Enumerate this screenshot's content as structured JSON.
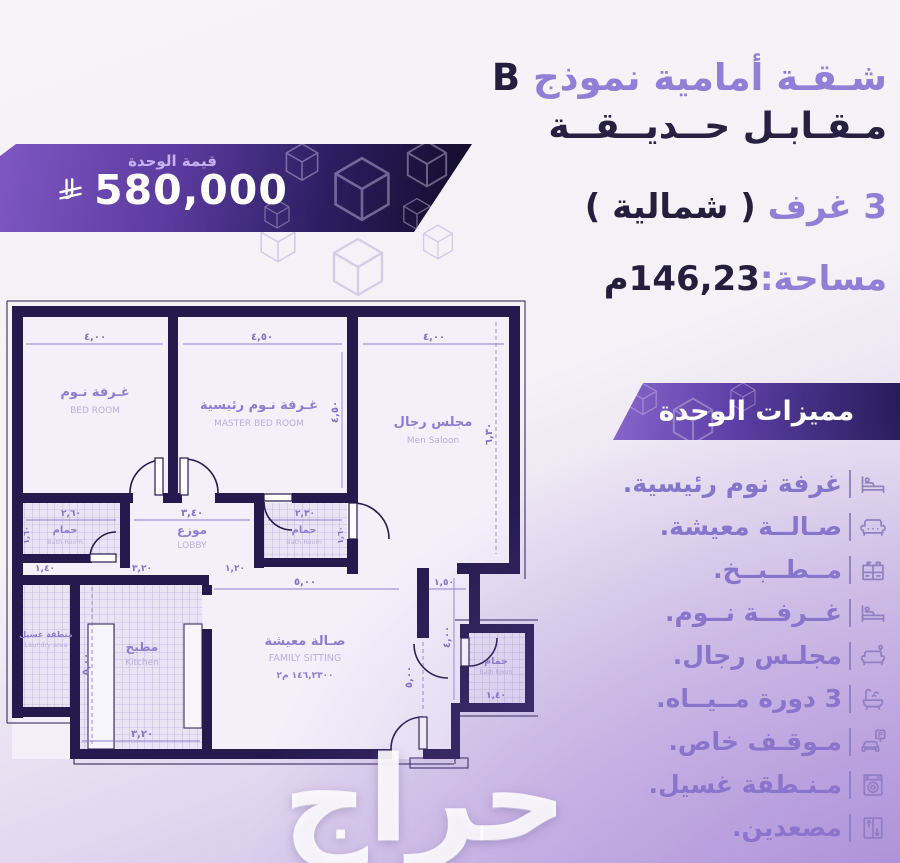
{
  "page": {
    "watermark": "حراج"
  },
  "price_banner": {
    "label": "قيمة الوحدة",
    "amount": "580,000",
    "currency_icon": "saudi-riyal-icon"
  },
  "header": {
    "title": "شـقـة أمامية نموذج",
    "title_model": "B",
    "subtitle": "مـقـابـل حــديــقــة",
    "rooms_count": "3 غرف",
    "rooms_side": "( شمالية )",
    "area_label": "مساحة:",
    "area_value": "146,23م"
  },
  "features": {
    "header": "مميزات الوحدة",
    "parking_sign": "P",
    "items": [
      {
        "label": "غرفة نوم رئيسية.",
        "icon": "bed-icon"
      },
      {
        "label": "صـالــة معيشة.",
        "icon": "sofa-icon"
      },
      {
        "label": "مــطــبــخ.",
        "icon": "kitchen-icon"
      },
      {
        "label": "غــرفــة نــوم.",
        "icon": "bed-icon"
      },
      {
        "label": "مجلـس رجال.",
        "icon": "majlis-sofa-icon"
      },
      {
        "label": "3 دورة مــيــاه.",
        "icon": "bathtub-icon"
      },
      {
        "label": "مـوقـف خاص.",
        "icon": "parking-icon"
      },
      {
        "label": "مـنـطقة غسيل.",
        "icon": "washing-machine-icon"
      },
      {
        "label": "مصعدين.",
        "icon": "elevator-icon"
      }
    ]
  },
  "floor_plan": {
    "rooms": {
      "bedroom": {
        "name_ar": "غـرفة نـوم",
        "name_en": "BED ROOM",
        "width": "٤,٠٠"
      },
      "master": {
        "name_ar": "غـرفة نـوم رئيسية",
        "name_en": "MASTER BED ROOM",
        "width": "٤,٥٠",
        "height": "٤,٥٠"
      },
      "saloon": {
        "name_ar": "مجلس رجال",
        "name_en": "Men Saloon",
        "width": "٤,٠٠",
        "height": "٦,٣٠"
      },
      "bath1": {
        "name_ar": "حمام",
        "name_en": "Bath Room",
        "width": "٢,٦٠",
        "height": "١,٦٠"
      },
      "lobby": {
        "name_ar": "موزع",
        "name_en": "LOBBY",
        "width": "٣,٤٠"
      },
      "bath2": {
        "name_ar": "حمام",
        "name_en": "Bath Room",
        "width": "٢,٣٠",
        "height": "١,٦٠"
      },
      "laundry": {
        "name_ar": "منطقة غسيل",
        "name_en": "Laundry area",
        "width": "١,٤٠"
      },
      "kitchen": {
        "name_ar": "مطبخ",
        "name_en": "Kitchen",
        "width": "٣,٢٠",
        "width_bottom": "٣,٢٠",
        "height": "٥,٠٠"
      },
      "family": {
        "name_ar": "صـالة معيشة",
        "name_en": "FAMILY SITTING",
        "area": "١٤٦,٢٣٠٠ م٢",
        "width": "٥,٠٠",
        "height": "٥,٠٠"
      },
      "bath3": {
        "name_ar": "حمام",
        "name_en": "Bath Room",
        "width": "١,٤٠"
      },
      "passage": {
        "width": "١,٢٠"
      },
      "entry": {
        "width": "١,٥٠",
        "height": "٤,٠٠"
      }
    }
  }
}
